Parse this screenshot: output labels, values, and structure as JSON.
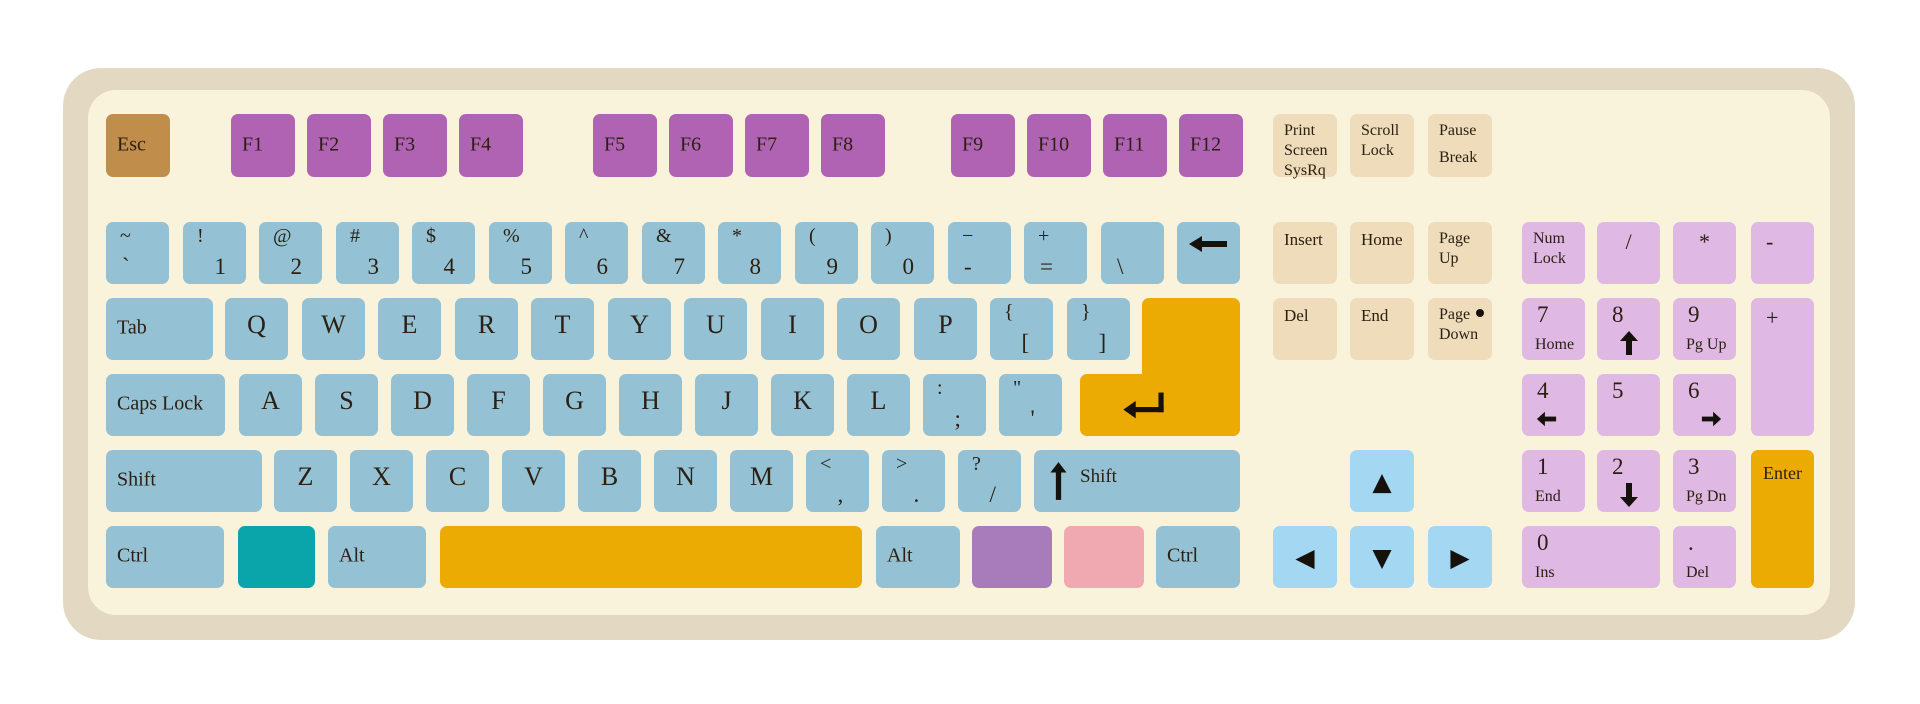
{
  "keyboard": {
    "colors": {
      "frame": "#E3D9C2",
      "surface": "#FAF3DC",
      "esc": "#C08D4B",
      "fn": "#B163B3",
      "alpha": "#94C1D4",
      "sys": "#EFDCBA",
      "arrow": "#A3D7F2",
      "pad": "#DFB8E4",
      "accent": "#EBAB03",
      "teal": "#0AA4AB",
      "purple": "#A87CBA",
      "pink": "#F0A9B1",
      "glyph": "#15120C"
    },
    "keys": [
      {
        "name": "key-esc",
        "color": "esc",
        "x": 106,
        "y": 114,
        "w": 64,
        "h": 63,
        "label": "Esc"
      },
      {
        "name": "key-f1",
        "color": "fn",
        "x": 231,
        "y": 114,
        "w": 64,
        "h": 63,
        "label": "F1"
      },
      {
        "name": "key-f2",
        "color": "fn",
        "x": 307,
        "y": 114,
        "w": 64,
        "h": 63,
        "label": "F2"
      },
      {
        "name": "key-f3",
        "color": "fn",
        "x": 383,
        "y": 114,
        "w": 64,
        "h": 63,
        "label": "F3"
      },
      {
        "name": "key-f4",
        "color": "fn",
        "x": 459,
        "y": 114,
        "w": 64,
        "h": 63,
        "label": "F4"
      },
      {
        "name": "key-f5",
        "color": "fn",
        "x": 593,
        "y": 114,
        "w": 64,
        "h": 63,
        "label": "F5"
      },
      {
        "name": "key-f6",
        "color": "fn",
        "x": 669,
        "y": 114,
        "w": 64,
        "h": 63,
        "label": "F6"
      },
      {
        "name": "key-f7",
        "color": "fn",
        "x": 745,
        "y": 114,
        "w": 64,
        "h": 63,
        "label": "F7"
      },
      {
        "name": "key-f8",
        "color": "fn",
        "x": 821,
        "y": 114,
        "w": 64,
        "h": 63,
        "label": "F8"
      },
      {
        "name": "key-f9",
        "color": "fn",
        "x": 951,
        "y": 114,
        "w": 64,
        "h": 63,
        "label": "F9"
      },
      {
        "name": "key-f10",
        "color": "fn",
        "x": 1027,
        "y": 114,
        "w": 64,
        "h": 63,
        "label": "F10"
      },
      {
        "name": "key-f11",
        "color": "fn",
        "x": 1103,
        "y": 114,
        "w": 64,
        "h": 63,
        "label": "F11"
      },
      {
        "name": "key-f12",
        "color": "fn",
        "x": 1179,
        "y": 114,
        "w": 64,
        "h": 63,
        "label": "F12"
      },
      {
        "name": "key-print-screen",
        "color": "sys",
        "x": 1273,
        "y": 114,
        "w": 64,
        "h": 63,
        "cls": "sys3",
        "lines": [
          "Print",
          "Screen",
          "SysRq"
        ]
      },
      {
        "name": "key-scroll-lock",
        "color": "sys",
        "x": 1350,
        "y": 114,
        "w": 64,
        "h": 63,
        "lines": [
          "Scroll",
          "Lock"
        ]
      },
      {
        "name": "key-pause-break",
        "color": "sys",
        "x": 1428,
        "y": 114,
        "w": 64,
        "h": 63,
        "cls": "spread",
        "lines": [
          "Pause",
          "Break"
        ]
      },
      {
        "name": "key-grave",
        "x": 106,
        "y": 222,
        "cls": "bot-left",
        "top": "~",
        "bottom": "`"
      },
      {
        "name": "key-1",
        "x": 183,
        "y": 222,
        "top": "!",
        "bottom": "1"
      },
      {
        "name": "key-2",
        "x": 259,
        "y": 222,
        "top": "@",
        "bottom": "2"
      },
      {
        "name": "key-3",
        "x": 336,
        "y": 222,
        "top": "#",
        "bottom": "3"
      },
      {
        "name": "key-4",
        "x": 412,
        "y": 222,
        "top": "$",
        "bottom": "4"
      },
      {
        "name": "key-5",
        "x": 489,
        "y": 222,
        "top": "%",
        "bottom": "5"
      },
      {
        "name": "key-6",
        "x": 565,
        "y": 222,
        "top": "^",
        "bottom": "6"
      },
      {
        "name": "key-7",
        "x": 642,
        "y": 222,
        "top": "&",
        "bottom": "7"
      },
      {
        "name": "key-8",
        "x": 718,
        "y": 222,
        "top": "*",
        "bottom": "8"
      },
      {
        "name": "key-9",
        "x": 795,
        "y": 222,
        "top": "(",
        "bottom": "9"
      },
      {
        "name": "key-0",
        "x": 871,
        "y": 222,
        "top": ")",
        "bottom": "0"
      },
      {
        "name": "key-minus",
        "x": 948,
        "y": 222,
        "cls": "bot-left",
        "top": "−",
        "bottom": "-"
      },
      {
        "name": "key-equals",
        "x": 1024,
        "y": 222,
        "cls": "bot-left",
        "top": "+",
        "bottom": "="
      },
      {
        "name": "key-backslash",
        "x": 1101,
        "y": 222,
        "cls": "bot-left",
        "bottom": "\\"
      },
      {
        "name": "key-backspace",
        "x": 1177,
        "y": 222,
        "icon": "long-left",
        "iconName": "backspace-arrow",
        "iconCls": "icon-backspace"
      },
      {
        "name": "key-tab",
        "x": 106,
        "y": 298,
        "w": 107,
        "label": "Tab"
      },
      {
        "name": "key-q",
        "x": 225,
        "y": 298,
        "letter": "Q"
      },
      {
        "name": "key-w",
        "x": 302,
        "y": 298,
        "letter": "W"
      },
      {
        "name": "key-e",
        "x": 378,
        "y": 298,
        "letter": "E"
      },
      {
        "name": "key-r",
        "x": 455,
        "y": 298,
        "letter": "R"
      },
      {
        "name": "key-t",
        "x": 531,
        "y": 298,
        "letter": "T"
      },
      {
        "name": "key-y",
        "x": 608,
        "y": 298,
        "letter": "Y"
      },
      {
        "name": "key-u",
        "x": 684,
        "y": 298,
        "letter": "U"
      },
      {
        "name": "key-i",
        "x": 761,
        "y": 298,
        "letter": "I"
      },
      {
        "name": "key-o",
        "x": 837,
        "y": 298,
        "letter": "O"
      },
      {
        "name": "key-p",
        "x": 914,
        "y": 298,
        "letter": "P"
      },
      {
        "name": "key-bracket-left",
        "x": 990,
        "y": 298,
        "top": "{",
        "bottom": "["
      },
      {
        "name": "key-bracket-right",
        "x": 1067,
        "y": 298,
        "top": "}",
        "bottom": "]"
      },
      {
        "name": "key-enter-upper",
        "color": "accent",
        "x": 1142,
        "y": 298,
        "w": 98,
        "h": 138
      },
      {
        "name": "key-enter-lower",
        "color": "accent",
        "x": 1080,
        "y": 374,
        "w": 160,
        "h": 62,
        "icon": "return",
        "iconName": "return-arrow",
        "iconCls": "icon-return"
      },
      {
        "name": "key-caps-lock",
        "x": 106,
        "y": 374,
        "w": 119,
        "label": "Caps Lock"
      },
      {
        "name": "key-a",
        "x": 239,
        "y": 374,
        "letter": "A"
      },
      {
        "name": "key-s",
        "x": 315,
        "y": 374,
        "letter": "S"
      },
      {
        "name": "key-d",
        "x": 391,
        "y": 374,
        "letter": "D"
      },
      {
        "name": "key-f",
        "x": 467,
        "y": 374,
        "letter": "F"
      },
      {
        "name": "key-g",
        "x": 543,
        "y": 374,
        "letter": "G"
      },
      {
        "name": "key-h",
        "x": 619,
        "y": 374,
        "letter": "H"
      },
      {
        "name": "key-j",
        "x": 695,
        "y": 374,
        "letter": "J"
      },
      {
        "name": "key-k",
        "x": 771,
        "y": 374,
        "letter": "K"
      },
      {
        "name": "key-l",
        "x": 847,
        "y": 374,
        "letter": "L"
      },
      {
        "name": "key-semicolon",
        "x": 923,
        "y": 374,
        "top": ":",
        "bottom": ";"
      },
      {
        "name": "key-quote",
        "x": 999,
        "y": 374,
        "top": "\"",
        "bottom": "'"
      },
      {
        "name": "key-shift-left",
        "x": 106,
        "y": 450,
        "w": 156,
        "label": "Shift"
      },
      {
        "name": "key-z",
        "x": 274,
        "y": 450,
        "letter": "Z"
      },
      {
        "name": "key-x",
        "x": 350,
        "y": 450,
        "letter": "X"
      },
      {
        "name": "key-c",
        "x": 426,
        "y": 450,
        "letter": "C"
      },
      {
        "name": "key-v",
        "x": 502,
        "y": 450,
        "letter": "V"
      },
      {
        "name": "key-b",
        "x": 578,
        "y": 450,
        "letter": "B"
      },
      {
        "name": "key-n",
        "x": 654,
        "y": 450,
        "letter": "N"
      },
      {
        "name": "key-m",
        "x": 730,
        "y": 450,
        "letter": "M"
      },
      {
        "name": "key-comma",
        "x": 806,
        "y": 450,
        "top": "<",
        "bottom": ","
      },
      {
        "name": "key-period",
        "x": 882,
        "y": 450,
        "top": ">",
        "bottom": "."
      },
      {
        "name": "key-slash",
        "x": 958,
        "y": 450,
        "top": "?",
        "bottom": "/"
      },
      {
        "name": "key-shift-right",
        "x": 1034,
        "y": 450,
        "w": 206,
        "cls": "shiftr",
        "label": "Shift",
        "icon": "shift-up",
        "iconName": "shift-arrow",
        "iconCls": "icon-shift"
      },
      {
        "name": "key-ctrl-left",
        "x": 106,
        "y": 526,
        "w": 118,
        "label": "Ctrl"
      },
      {
        "name": "key-blank-teal",
        "color": "teal",
        "x": 238,
        "y": 526,
        "w": 77
      },
      {
        "name": "key-alt-left",
        "x": 328,
        "y": 526,
        "w": 98,
        "label": "Alt"
      },
      {
        "name": "key-space",
        "color": "accent",
        "x": 440,
        "y": 526,
        "w": 422
      },
      {
        "name": "key-alt-right",
        "x": 876,
        "y": 526,
        "w": 84,
        "label": "Alt"
      },
      {
        "name": "key-blank-purple",
        "color": "purple",
        "x": 972,
        "y": 526,
        "w": 80
      },
      {
        "name": "key-blank-pink",
        "color": "pink",
        "x": 1064,
        "y": 526,
        "w": 80
      },
      {
        "name": "key-ctrl-right",
        "x": 1156,
        "y": 526,
        "w": 84,
        "label": "Ctrl"
      },
      {
        "name": "key-insert",
        "color": "sys",
        "x": 1273,
        "y": 222,
        "w": 64,
        "cls": "nav",
        "label": "Insert"
      },
      {
        "name": "key-home",
        "color": "sys",
        "x": 1350,
        "y": 222,
        "w": 64,
        "cls": "nav",
        "label": "Home"
      },
      {
        "name": "key-page-up",
        "color": "sys",
        "x": 1428,
        "y": 222,
        "w": 64,
        "lines": [
          "Page",
          "Up"
        ]
      },
      {
        "name": "key-delete",
        "color": "sys",
        "x": 1273,
        "y": 298,
        "w": 64,
        "cls": "nav",
        "label": "Del"
      },
      {
        "name": "key-end",
        "color": "sys",
        "x": 1350,
        "y": 298,
        "w": 64,
        "cls": "nav",
        "label": "End"
      },
      {
        "name": "key-page-down",
        "color": "sys",
        "x": 1428,
        "y": 298,
        "w": 64,
        "lines": [
          "Page",
          "Down"
        ],
        "dot": true
      },
      {
        "name": "key-arrow-up",
        "color": "arrow",
        "x": 1350,
        "y": 450,
        "w": 64,
        "tri": "▲"
      },
      {
        "name": "key-arrow-left",
        "color": "arrow",
        "x": 1273,
        "y": 526,
        "w": 64,
        "tri": "◀"
      },
      {
        "name": "key-arrow-down",
        "color": "arrow",
        "x": 1350,
        "y": 526,
        "w": 64,
        "tri": "▼"
      },
      {
        "name": "key-arrow-right",
        "color": "arrow",
        "x": 1428,
        "y": 526,
        "w": 64,
        "tri": "▶"
      },
      {
        "name": "key-num-lock",
        "color": "pad",
        "x": 1522,
        "y": 222,
        "lines": [
          "Num",
          "Lock"
        ]
      },
      {
        "name": "key-numpad-divide",
        "color": "pad",
        "x": 1597,
        "y": 222,
        "op": "/"
      },
      {
        "name": "key-numpad-multiply",
        "color": "pad",
        "x": 1673,
        "y": 222,
        "op": "*"
      },
      {
        "name": "key-numpad-minus",
        "color": "pad",
        "x": 1751,
        "y": 222,
        "cls": "op-left",
        "op": "-"
      },
      {
        "name": "key-numpad-7",
        "color": "pad",
        "x": 1522,
        "y": 298,
        "digit": "7",
        "sub": "Home"
      },
      {
        "name": "key-numpad-8",
        "color": "pad",
        "x": 1597,
        "y": 298,
        "digit": "8",
        "icon": "up",
        "iconName": "numpad-up-arrow",
        "iconCls": "np-ic c"
      },
      {
        "name": "key-numpad-9",
        "color": "pad",
        "x": 1673,
        "y": 298,
        "digit": "9",
        "sub": "Pg Up"
      },
      {
        "name": "key-numpad-plus",
        "color": "pad",
        "x": 1751,
        "y": 298,
        "h": 138,
        "cls": "op-left",
        "op": "+"
      },
      {
        "name": "key-numpad-4",
        "color": "pad",
        "x": 1522,
        "y": 374,
        "digit": "4",
        "icon": "left",
        "iconName": "numpad-left-arrow",
        "iconCls": "np-ic l"
      },
      {
        "name": "key-numpad-5",
        "color": "pad",
        "x": 1597,
        "y": 374,
        "digit": "5"
      },
      {
        "name": "key-numpad-6",
        "color": "pad",
        "x": 1673,
        "y": 374,
        "digit": "6",
        "icon": "right",
        "iconName": "numpad-right-arrow",
        "iconCls": "np-ic r"
      },
      {
        "name": "key-numpad-1",
        "color": "pad",
        "x": 1522,
        "y": 450,
        "digit": "1",
        "sub": "End"
      },
      {
        "name": "key-numpad-2",
        "color": "pad",
        "x": 1597,
        "y": 450,
        "digit": "2",
        "icon": "down",
        "iconName": "numpad-down-arrow",
        "iconCls": "np-ic c"
      },
      {
        "name": "key-numpad-3",
        "color": "pad",
        "x": 1673,
        "y": 450,
        "digit": "3",
        "sub": "Pg Dn"
      },
      {
        "name": "key-numpad-enter",
        "color": "accent",
        "x": 1751,
        "y": 450,
        "h": 138,
        "cls": "np-enter",
        "label": "Enter"
      },
      {
        "name": "key-numpad-0",
        "color": "pad",
        "x": 1522,
        "y": 526,
        "w": 138,
        "digit": "0",
        "sub": "Ins"
      },
      {
        "name": "key-numpad-decimal",
        "color": "pad",
        "x": 1673,
        "y": 526,
        "digit": ".",
        "sub": "Del"
      }
    ]
  }
}
